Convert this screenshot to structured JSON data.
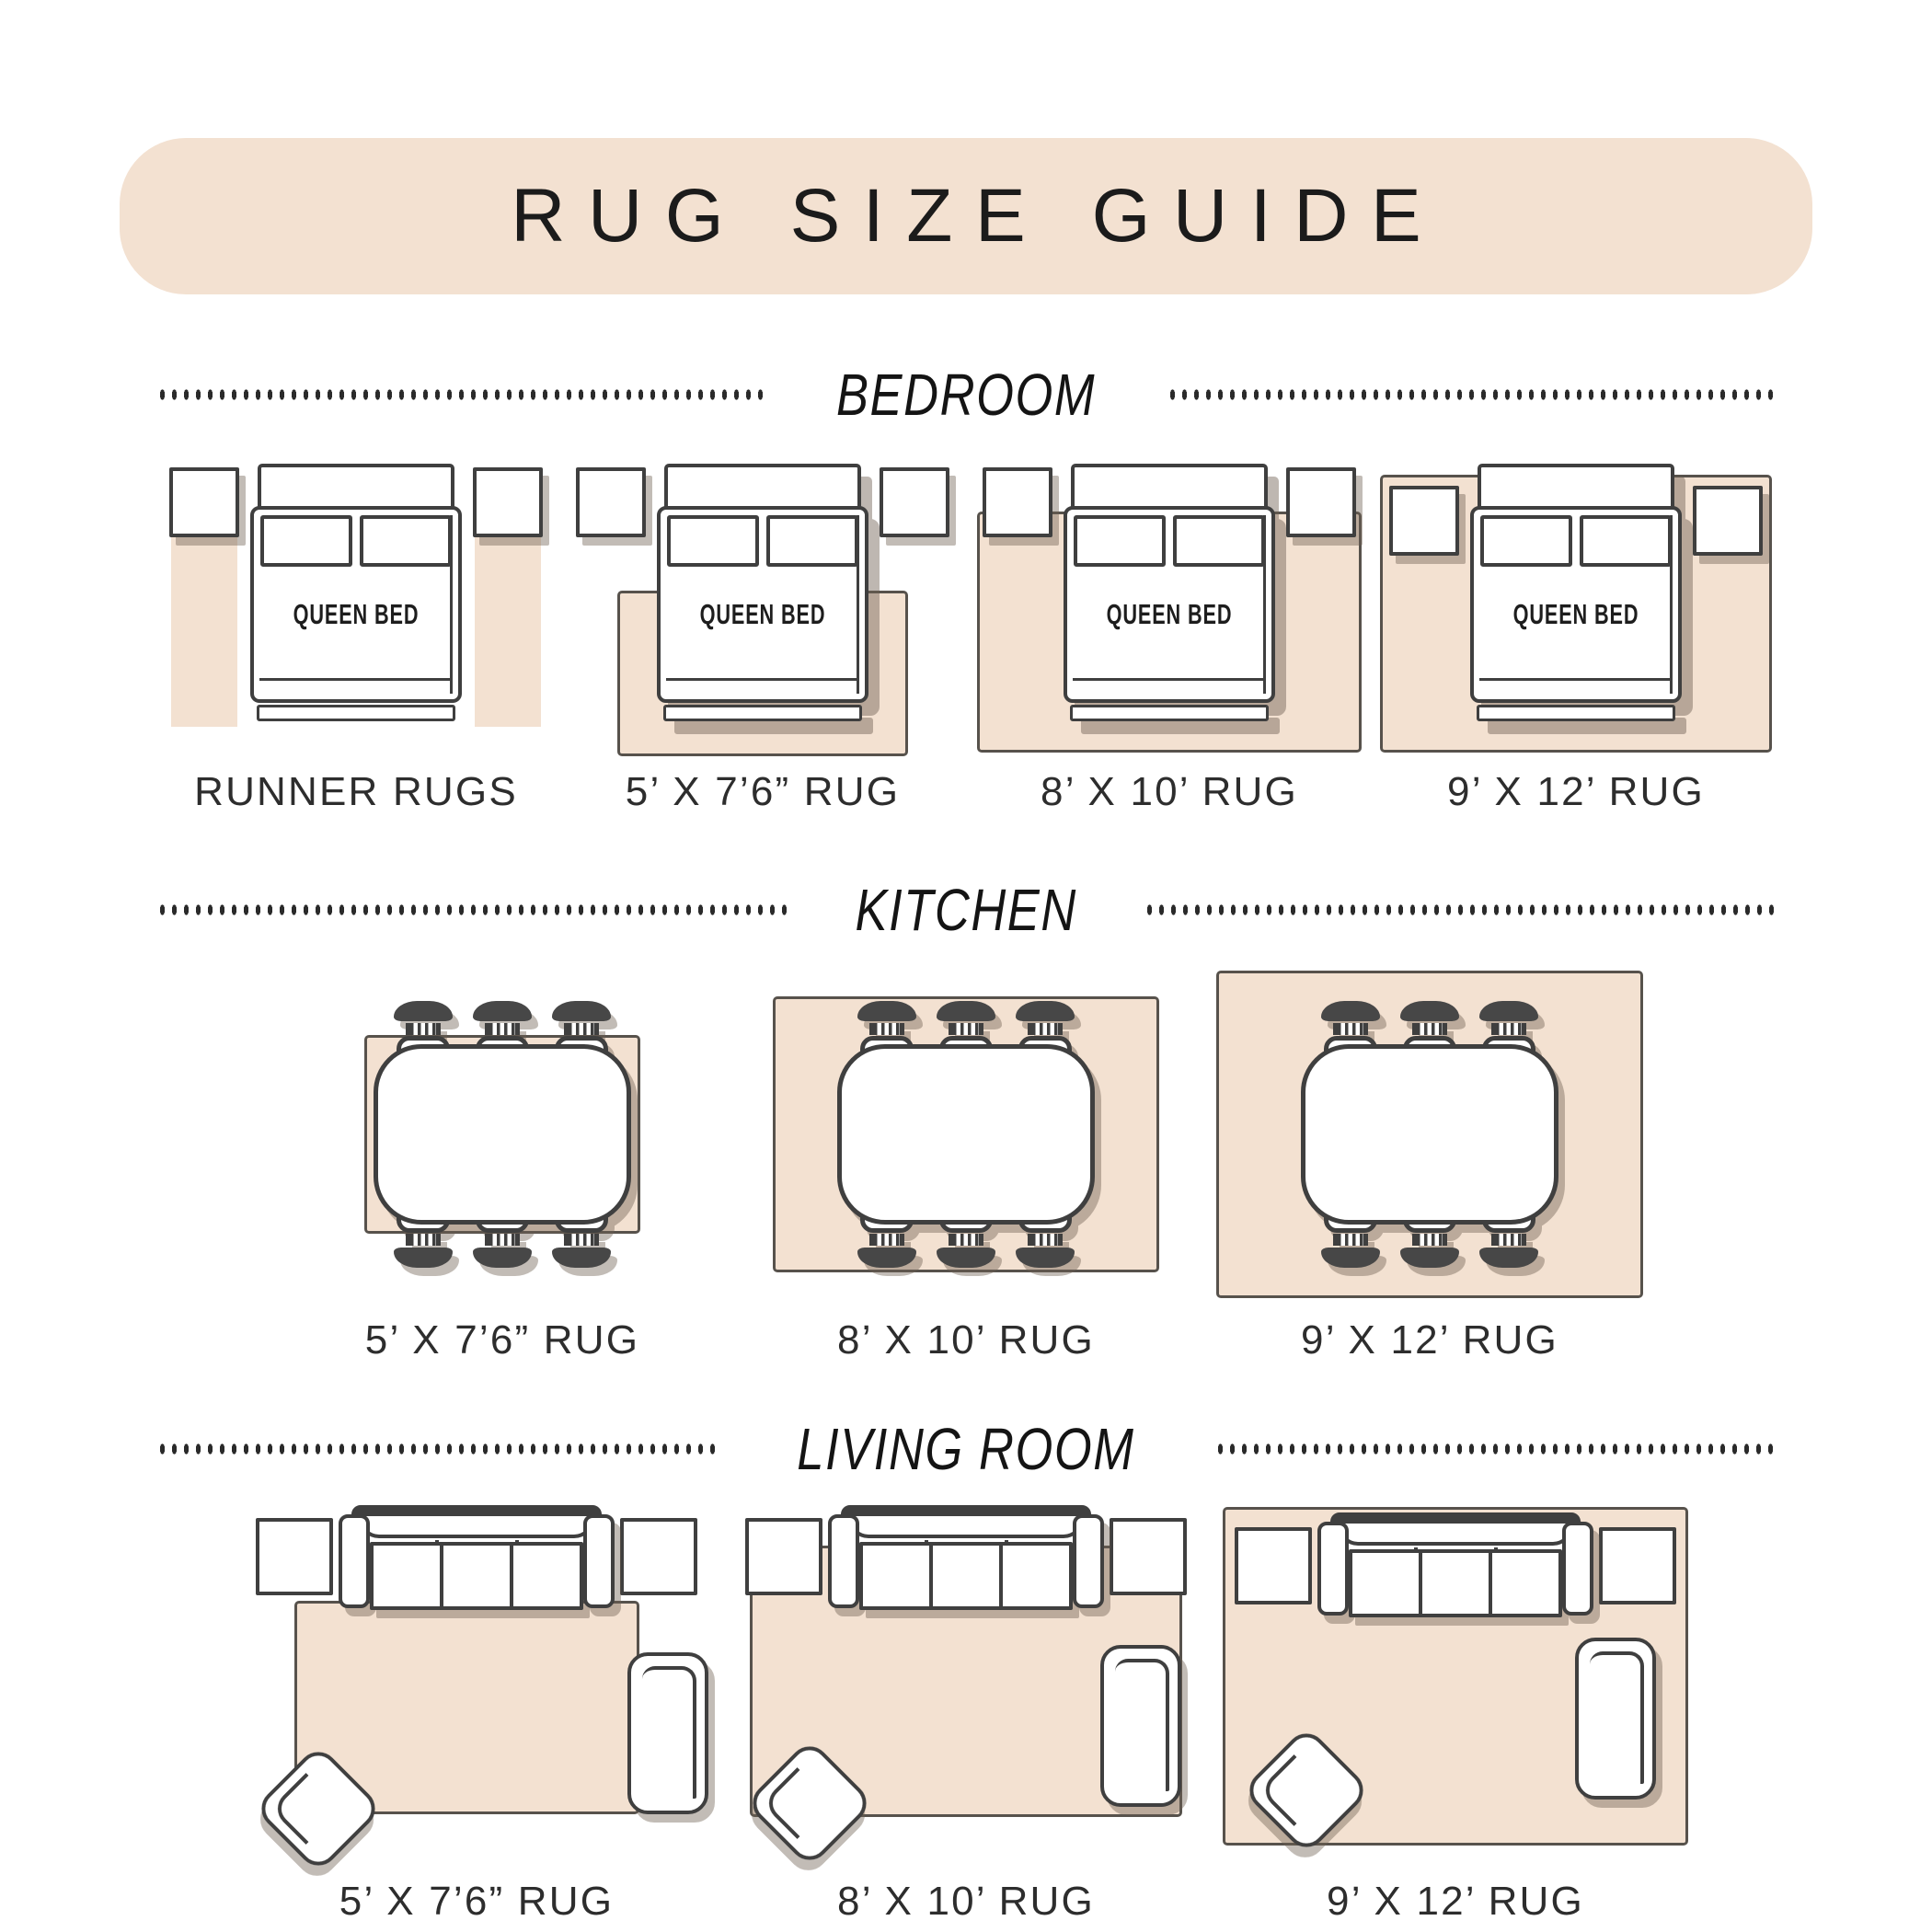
{
  "title": "RUG SIZE GUIDE",
  "furniture": {
    "queen_bed": "QUEEN BED"
  },
  "sections": {
    "bedroom": {
      "name": "BEDROOM",
      "items": [
        {
          "label": "RUNNER RUGS"
        },
        {
          "label": "5’ X 7’6” RUG"
        },
        {
          "label": "8’ X 10’ RUG"
        },
        {
          "label": "9’ X 12’ RUG"
        }
      ]
    },
    "kitchen": {
      "name": "KITCHEN",
      "items": [
        {
          "label": "5’ X 7’6” RUG"
        },
        {
          "label": "8’ X 10’ RUG"
        },
        {
          "label": "9’ X 12’ RUG"
        }
      ]
    },
    "living_room": {
      "name": "LIVING ROOM",
      "items": [
        {
          "label": "5’ X 7’6” RUG"
        },
        {
          "label": "8’ X 10’ RUG"
        },
        {
          "label": "9’ X 12’ RUG"
        }
      ]
    }
  },
  "colors": {
    "background": "#ffffff",
    "accent_beige": "#f3e1d1",
    "outline": "#3f3f3f",
    "rug_border": "#57524c",
    "label_text": "#2d2d2d"
  }
}
